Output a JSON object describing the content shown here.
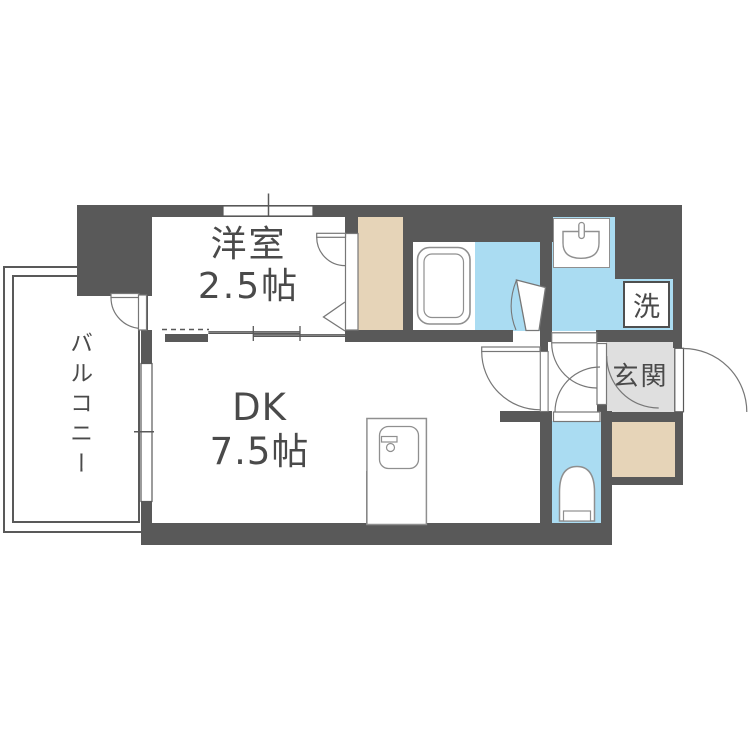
{
  "title": "1DK apartment floor plan",
  "rooms": {
    "western_room": {
      "name": "洋室",
      "size": "2.5帖"
    },
    "dining_kitchen": {
      "name": "DK",
      "size": "7.5帖"
    },
    "balcony": {
      "name": "バルコニー"
    },
    "entrance": {
      "name": "玄関"
    },
    "laundry": {
      "abbr": "洗"
    }
  },
  "fixtures": [
    "bathtub",
    "washbasin",
    "toilet",
    "kitchen-sink-unit",
    "closet",
    "shoe-cabinet",
    "washing-machine-space",
    "sliding-partition",
    "entrance-door",
    "balcony-window"
  ],
  "colors": {
    "wall": "#595959",
    "wet_area_blue": "#aadcf2",
    "closet_beige": "#e6d4b8",
    "entrance_gray": "#dfdfdf",
    "fixture_outline": "#8f8f8f",
    "text": "#4a4a4a",
    "background": "#ffffff"
  }
}
